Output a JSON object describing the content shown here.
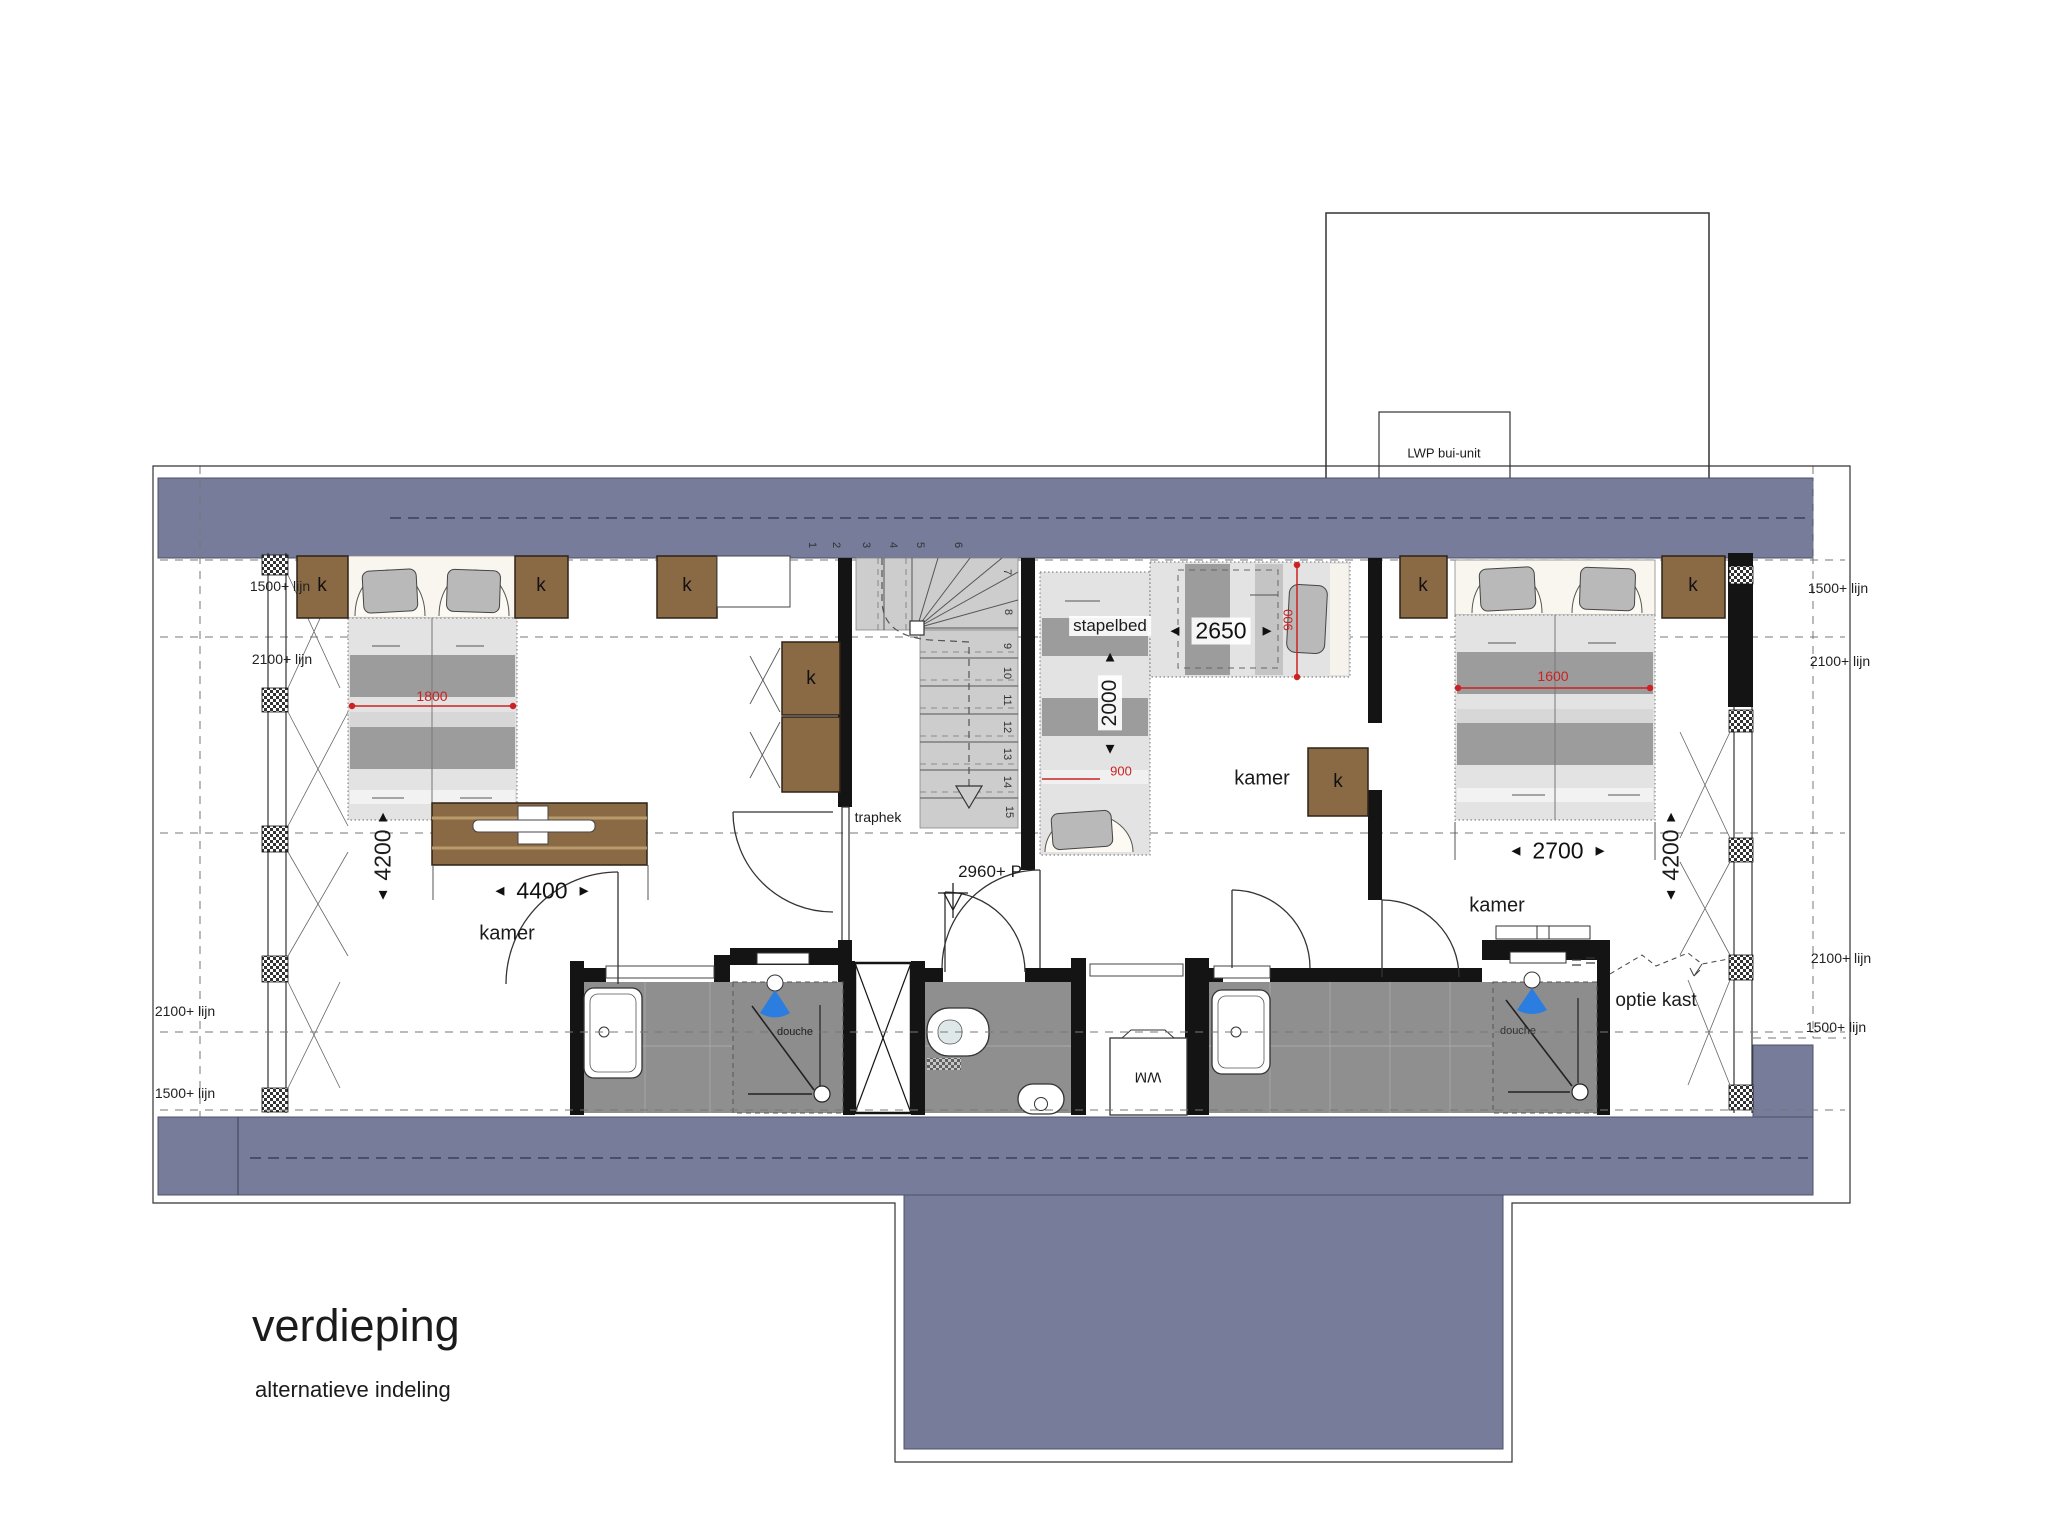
{
  "meta": {
    "title": "verdieping",
    "subtitle": "alternatieve indeling"
  },
  "roof_terrace": {
    "unit_label": "LWP bui-unit"
  },
  "height_lines": {
    "h1500": "1500+ lijn",
    "h2100": "2100+ lijn"
  },
  "labels": {
    "bedroom": "kamer",
    "bunkbed": "stapelbed",
    "shower": "douche",
    "stair_rail": "traphek",
    "closet": "k",
    "washing_machine": "WM",
    "closet_option": "optie kast",
    "level_mark": "2960+ P"
  },
  "dimensions": {
    "left_bed_width": "1800",
    "left_room_width": "4400",
    "room_depth": "4200",
    "bunk_room_width": "2650",
    "bunk_length": "2000",
    "bunk_width": "900",
    "side_bed_width": "900",
    "right_bed_width": "1600",
    "right_room_width": "2700"
  },
  "icons": {
    "arrow_left": "◄",
    "arrow_right": "►",
    "arrow_up": "▲",
    "arrow_down": "▼"
  },
  "stairs": {
    "numbers": [
      "1",
      "2",
      "3",
      "4",
      "5",
      "6",
      "7",
      "8",
      "9",
      "10",
      "11",
      "12",
      "13",
      "14",
      "15"
    ]
  },
  "colors": {
    "roof_band": "#767c99",
    "wall": "#141414",
    "cabinet_brown": "#8a6a45",
    "tile_gray": "#8f8f8f",
    "dim_red": "#cc2222",
    "shower_blue": "#2b7de0"
  }
}
